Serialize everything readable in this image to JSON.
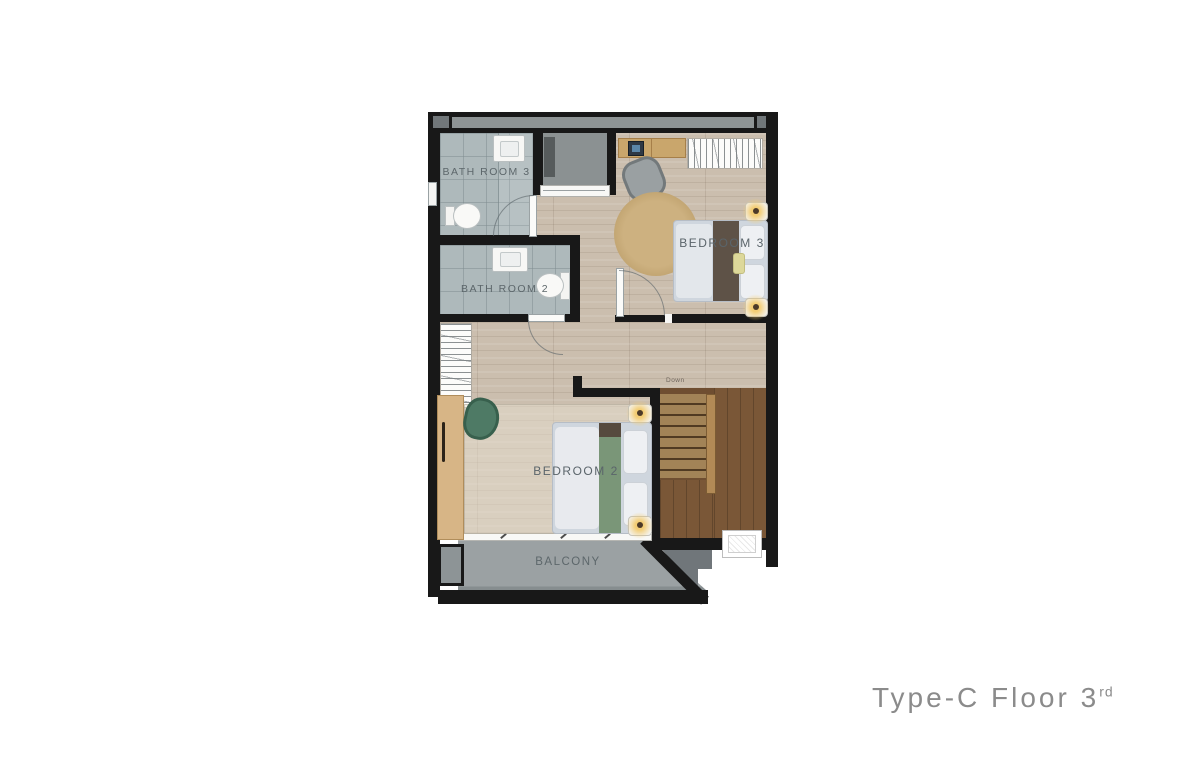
{
  "title": {
    "prefix": "Type-C Floor",
    "number": "3",
    "ordinal": "rd"
  },
  "rooms": {
    "bathroom_3": {
      "label": "BATH ROOM 3"
    },
    "bathroom_2": {
      "label": "BATH ROOM 2"
    },
    "bedroom_3": {
      "label": "BEDROOM 3"
    },
    "bedroom_2": {
      "label": "BEDROOM 2"
    },
    "balcony": {
      "label": "BALCONY"
    },
    "stairs": {
      "label": "Down"
    }
  },
  "furniture": {
    "bathroom_3": [
      "sink",
      "toilet",
      "door-swing"
    ],
    "bathroom_2": [
      "sink",
      "toilet",
      "door-swing"
    ],
    "bedroom_3": [
      "desk",
      "monitor",
      "office-chair",
      "hanger-wardrobe",
      "round-rug",
      "double-bed",
      "nightstand-lamp",
      "nightstand-lamp"
    ],
    "bedroom_2": [
      "wardrobe",
      "armchair",
      "rug",
      "double-bed",
      "nightstand-lamp",
      "nightstand-lamp"
    ],
    "hall": [
      "hanger-wardrobe",
      "walk-in-closet"
    ],
    "exterior": [
      "ac-unit"
    ]
  },
  "colors": {
    "wall": "#181818",
    "wood_floor": "#cbbeae",
    "tile_floor": "#aeb9bb",
    "closet_gray": "#8b9192",
    "balcony_floor": "#9ba1a3",
    "stair_tread": "#a28357",
    "stair_dark": "#6f4e31",
    "rug_tan": "#c9ad7c",
    "runner_green": "#7a9678",
    "runner_brown": "#5e5247",
    "duvet": "#cfd6de",
    "label_text": "#5d676b",
    "title_text": "#8b8b8b"
  }
}
